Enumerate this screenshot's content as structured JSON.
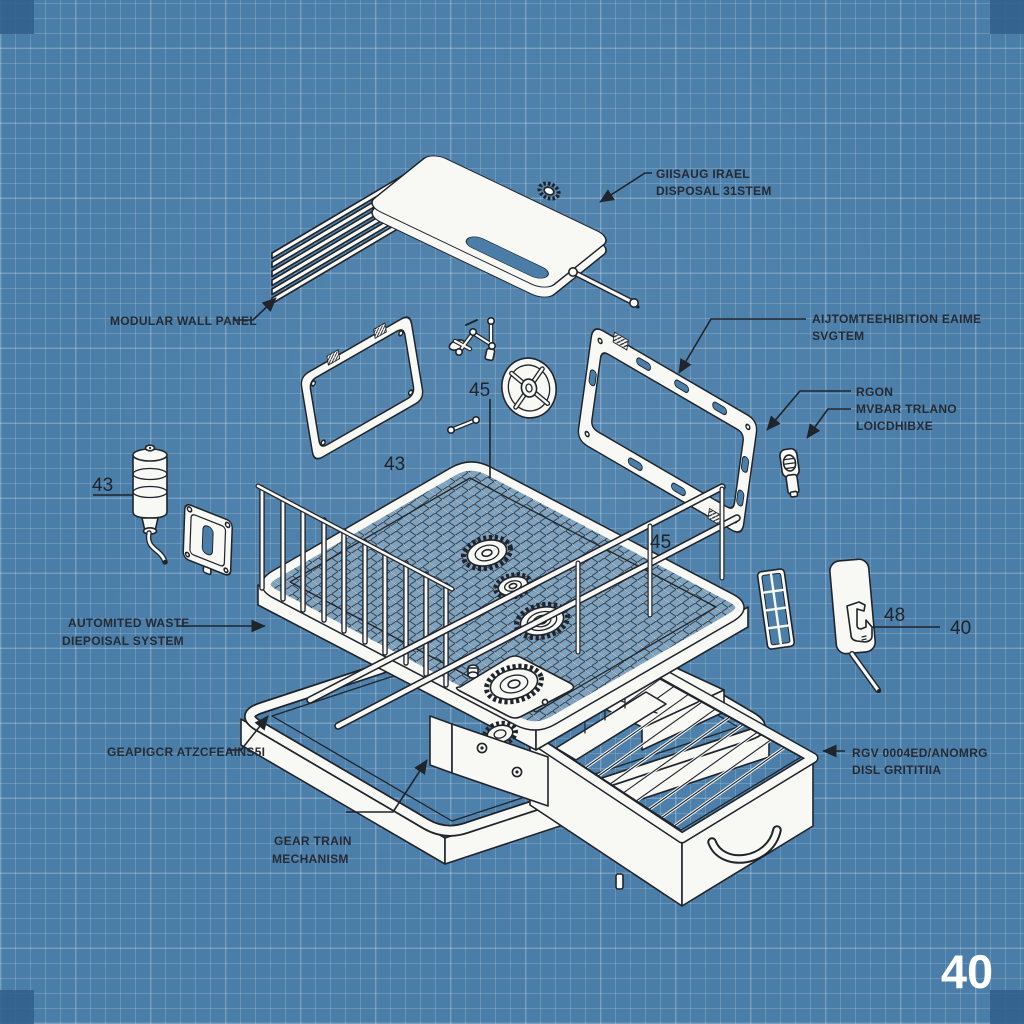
{
  "colors": {
    "background": "#4a7ea9",
    "grid_line": "#ffffff",
    "corner_marker": "#33618c",
    "ink": "#20242b",
    "paper": "#f8f8f5"
  },
  "labels": {
    "lid_system": {
      "line1": "GIISAUG IRAEL",
      "line2": "DISPOSAL 31STEM"
    },
    "wall_panel": {
      "line1": "MODULAR WALL PANEL"
    },
    "frame_system": {
      "line1": "AIJTOMTEEHIBITION EAIME",
      "line2": "SVGTEM"
    },
    "hinge_detail": {
      "line1": "RGON",
      "line2": "MVBAR TRLANO",
      "line3": "LOICDHIBXE"
    },
    "waste_system": {
      "line1": "AUTOMITED WASTE",
      "line2": "DIEPOISAL SYSTEM"
    },
    "gear_garbled": {
      "line1": "GEAPIGCR ATZCFEAINS5I"
    },
    "gear_train": {
      "line1": "GEAR TRAIN",
      "line2": "MECHANISM"
    },
    "drawer_label": {
      "line1": "RGV 0004ED/ANOMRG",
      "line2": "DISL GRITITIIA"
    }
  },
  "part_numbers": {
    "bottle": "43",
    "frame": "43",
    "top": "45",
    "cage": "45",
    "hook_panel": "48",
    "hook_leader": "40"
  },
  "sheet_number": "40"
}
